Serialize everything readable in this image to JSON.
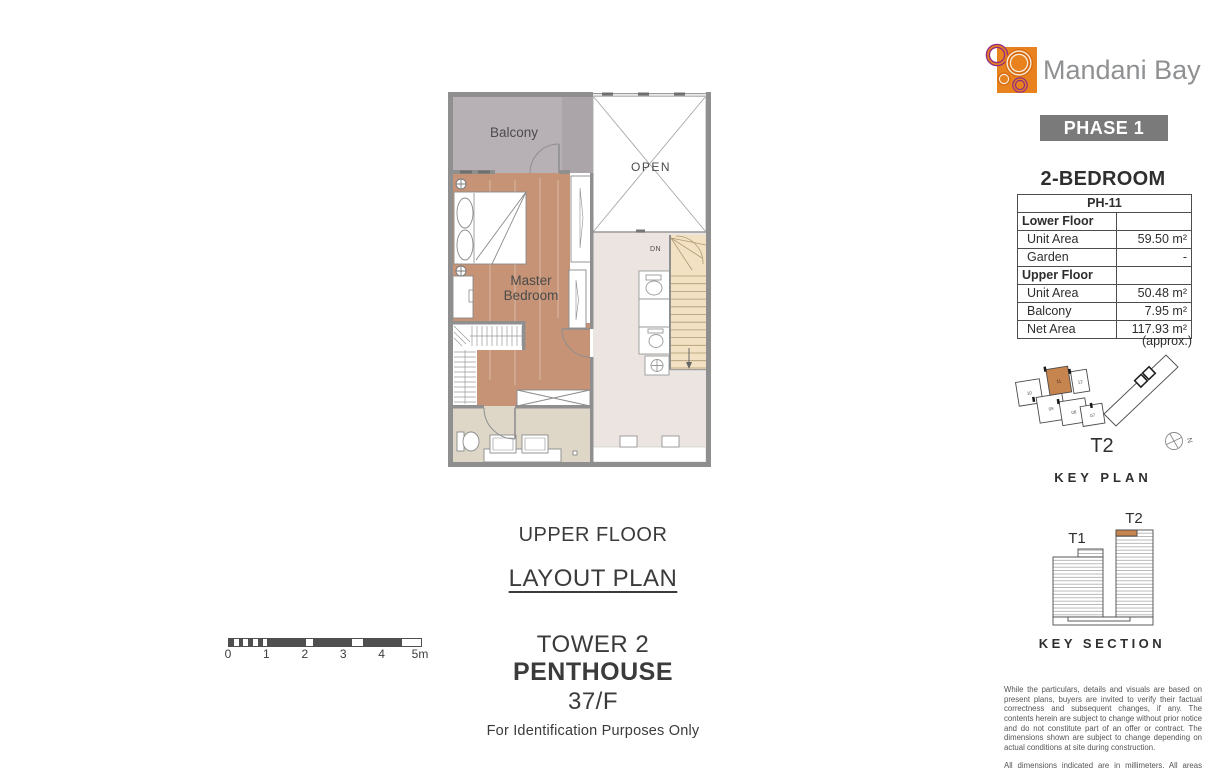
{
  "brand": {
    "name": "Mandani Bay",
    "phase_badge": "PHASE 1"
  },
  "unit": {
    "heading": "2-BEDROOM",
    "table": {
      "header": "PH-11",
      "rows": [
        {
          "label": "Lower Floor",
          "value": ""
        },
        {
          "label": "Unit Area",
          "value": "59.50 m²"
        },
        {
          "label": "Garden",
          "value": "-"
        },
        {
          "label": "Upper Floor",
          "value": ""
        },
        {
          "label": "Unit Area",
          "value": "50.48 m²"
        },
        {
          "label": "Balcony",
          "value": "7.95 m²"
        },
        {
          "label": "Net Area",
          "value": "117.93 m²"
        }
      ],
      "footnote": "(approx.)"
    }
  },
  "plan": {
    "room_labels": {
      "balcony": "Balcony",
      "open": "OPEN",
      "master_bedroom": "Master Bedroom",
      "stairs_down": "DN"
    }
  },
  "titles": {
    "floor": "UPPER FLOOR",
    "sheet": "LAYOUT PLAN",
    "tower": "TOWER 2",
    "unit_type": "PENTHOUSE",
    "level": "37/F",
    "purpose_note": "For Identification Purposes Only"
  },
  "scale_bar": {
    "ticks": [
      "0",
      "1",
      "2",
      "3",
      "4",
      "5m"
    ]
  },
  "key_plan": {
    "title": "KEY PLAN",
    "tower_label": "T2",
    "north_label": "N",
    "unit_numbers": [
      "10",
      "11",
      "12",
      "09",
      "08",
      "07"
    ]
  },
  "key_section": {
    "title": "KEY SECTION",
    "tower_labels": [
      "T1",
      "T2"
    ]
  },
  "disclaimer": {
    "paragraph1": "While the particulars, details and visuals are based on present plans, buyers are invited to verify their factual correctness and subsequent changes, if any. The contents herein are subject to change without prior notice and do not constitute part of an offer or contract. The dimensions shown are subject to change depending on actual conditions at site during construction.",
    "paragraph2": "All dimensions indicated are in millimeters. All areas indicated are in square meters."
  },
  "colors": {
    "brand_orange": "#E8821E",
    "brand_purple": "#8E2A86",
    "unit_highlight": "#C6854F",
    "badge_gray": "#7A7A7A",
    "wood_floor": "#C69376"
  }
}
